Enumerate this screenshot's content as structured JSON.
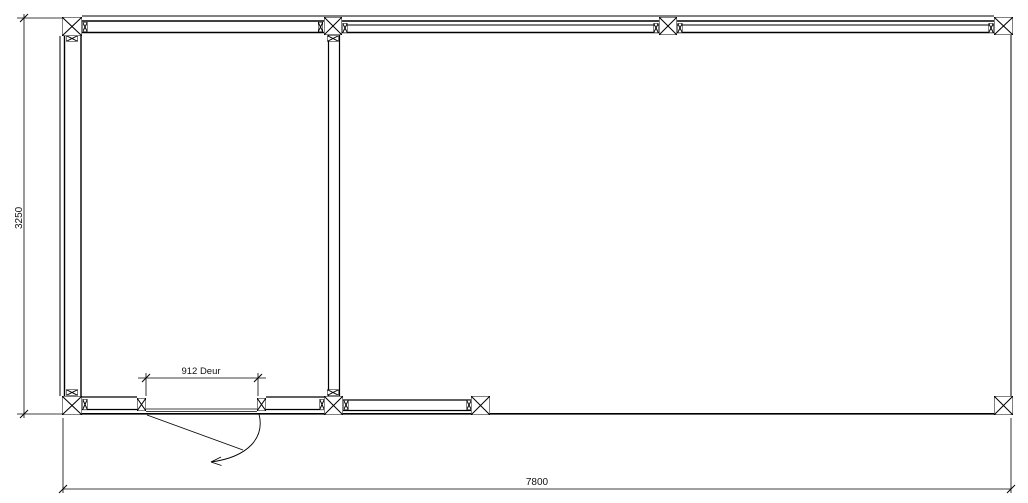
{
  "drawing": {
    "type": "floor-plan",
    "background": "#ffffff",
    "line_color": "#000000",
    "dim_height_label": "3250",
    "dim_width_label": "7800",
    "dim_door_label": "912 Deur"
  }
}
